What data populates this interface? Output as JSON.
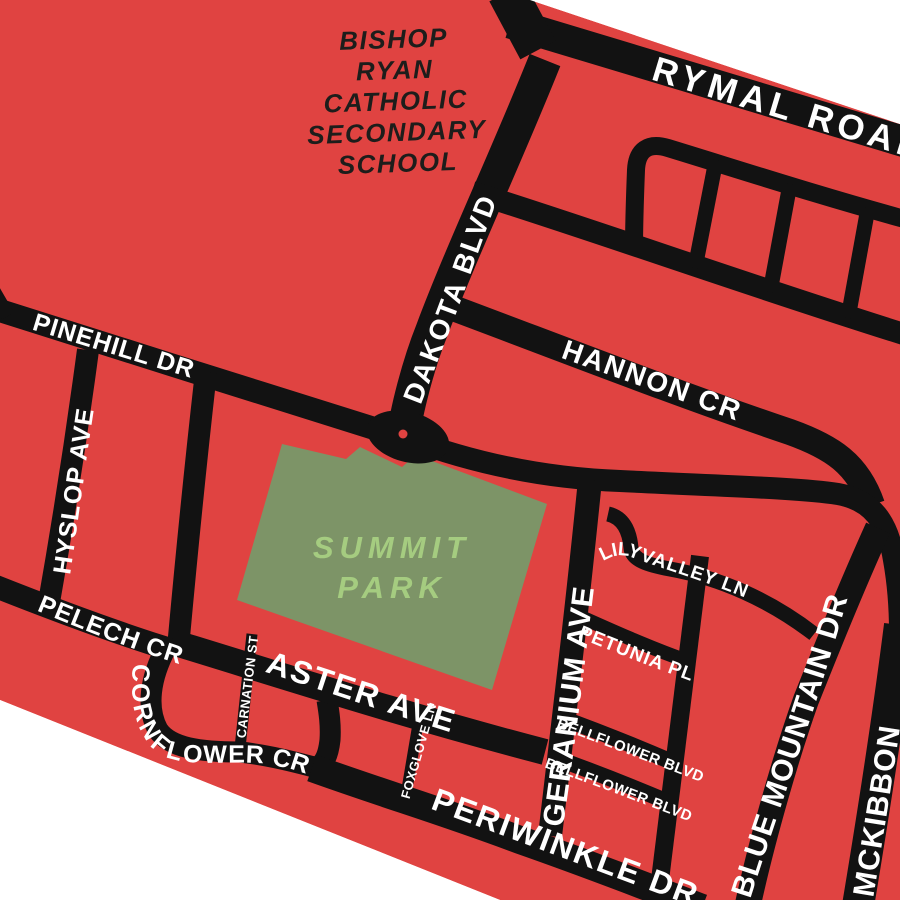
{
  "map": {
    "colors": {
      "background": "#FFFFFF",
      "block": "#E04341",
      "road": "#121212",
      "park": "#7D9467",
      "park_label": "#A5CC80",
      "school_label": "#1D1D1B",
      "street_label": "#FFFFFF",
      "junction_dot": "#E04341"
    },
    "school": {
      "lines": [
        "BISHOP",
        "RYAN",
        "CATHOLIC",
        "SECONDARY",
        "SCHOOL"
      ]
    },
    "park": {
      "line1": "SUMMIT",
      "line2": "PARK"
    },
    "streets": {
      "rymal": "RYMAL ROAD",
      "dakota": "DAKOTA BLVD",
      "hannon": "HANNON CR",
      "pinehill": "PINEHILL DR",
      "hyslop": "HYSLOP AVE",
      "pelech": "PELECH CR",
      "cornflower": "CORNFLOWER CR",
      "carnation": "CARNATION ST",
      "aster": "ASTER AVE",
      "foxglove": "FOXGLOVE LN",
      "periwinkle": "PERIWINKLE DR",
      "geranium": "GERANIUM AVE",
      "lilyvalley": "LILYVALLEY LN",
      "petunia": "PETUNIA PL",
      "bellflower_upper": "BELLFLOWER BLVD",
      "bellflower_lower": "BELLFLOWER BLVD",
      "blue_mountain": "BLUE MOUNTAIN DR",
      "mckibbon": "MCKIBBON"
    }
  }
}
